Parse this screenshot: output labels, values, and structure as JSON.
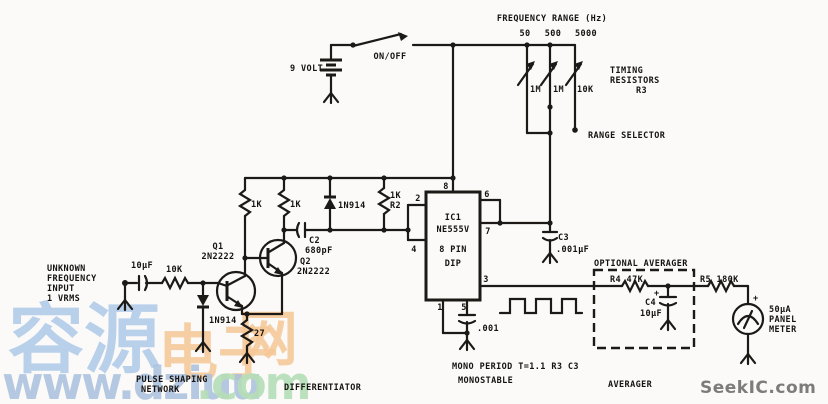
{
  "colors": {
    "ink": "#1c1916",
    "paper": "#fbfaf8",
    "watermark_blue": "#a9c6e9",
    "watermark_orange": "#f6c795",
    "watermark_green": "#b5deb7",
    "watermark_gray": "#6f6f6f"
  },
  "power": {
    "battery": "9 VOLT",
    "switch": "ON/OFF"
  },
  "range": {
    "title": "FREQUENCY RANGE (Hz)",
    "values": [
      "50",
      "500",
      "5000"
    ],
    "pots": [
      "1M",
      "1M",
      "10K"
    ],
    "timing": [
      "TIMING",
      "RESISTORS",
      "R3"
    ],
    "selector": "RANGE SELECTOR"
  },
  "input": {
    "lines": [
      "UNKNOWN",
      "FREQUENCY",
      "INPUT",
      "1 VRMS"
    ],
    "cap": "10μF",
    "res": "10K",
    "diode": "1N914"
  },
  "shaper": {
    "q1": [
      "Q1",
      "2N2222"
    ],
    "q2": [
      "Q2",
      "2N2222"
    ],
    "rc1": "1K",
    "rc2": "1K",
    "c2": [
      "C2",
      "680pF"
    ],
    "diode": "1N914",
    "r2": [
      "1K",
      "R2"
    ],
    "re": "27",
    "label1": [
      "PULSE SHAPING",
      "NETWORK"
    ],
    "label2": "DIFFERENTIATOR"
  },
  "ic": {
    "name": [
      "IC1",
      "NE555V",
      "8 PIN",
      "DIP"
    ],
    "pins": {
      "p8": "8",
      "p2": "2",
      "p4": "4",
      "p6": "6",
      "p7": "7",
      "p3": "3",
      "p1": "1",
      "p5": "5"
    },
    "c3": [
      "C3",
      ".001μF"
    ],
    "c5": ".001",
    "period": "MONO PERIOD T=1.1 R3 C3",
    "label": "MONOSTABLE"
  },
  "averager": {
    "title": "OPTIONAL AVERAGER",
    "r4": "R4 47K",
    "r5": "R5 180K",
    "c4": [
      "C4",
      "10μF"
    ],
    "plus": "+",
    "label": "AVERAGER"
  },
  "meter": {
    "lines": [
      "50μA",
      "PANEL",
      "METER"
    ],
    "plus": "+"
  },
  "watermarks": {
    "cn_blue": "容源",
    "cn_orange_a": "电子",
    "cn_orange_b": "网",
    "url_main": "www.dziuu",
    "url_tld": ".com",
    "seekic": "SeekIC.com"
  }
}
